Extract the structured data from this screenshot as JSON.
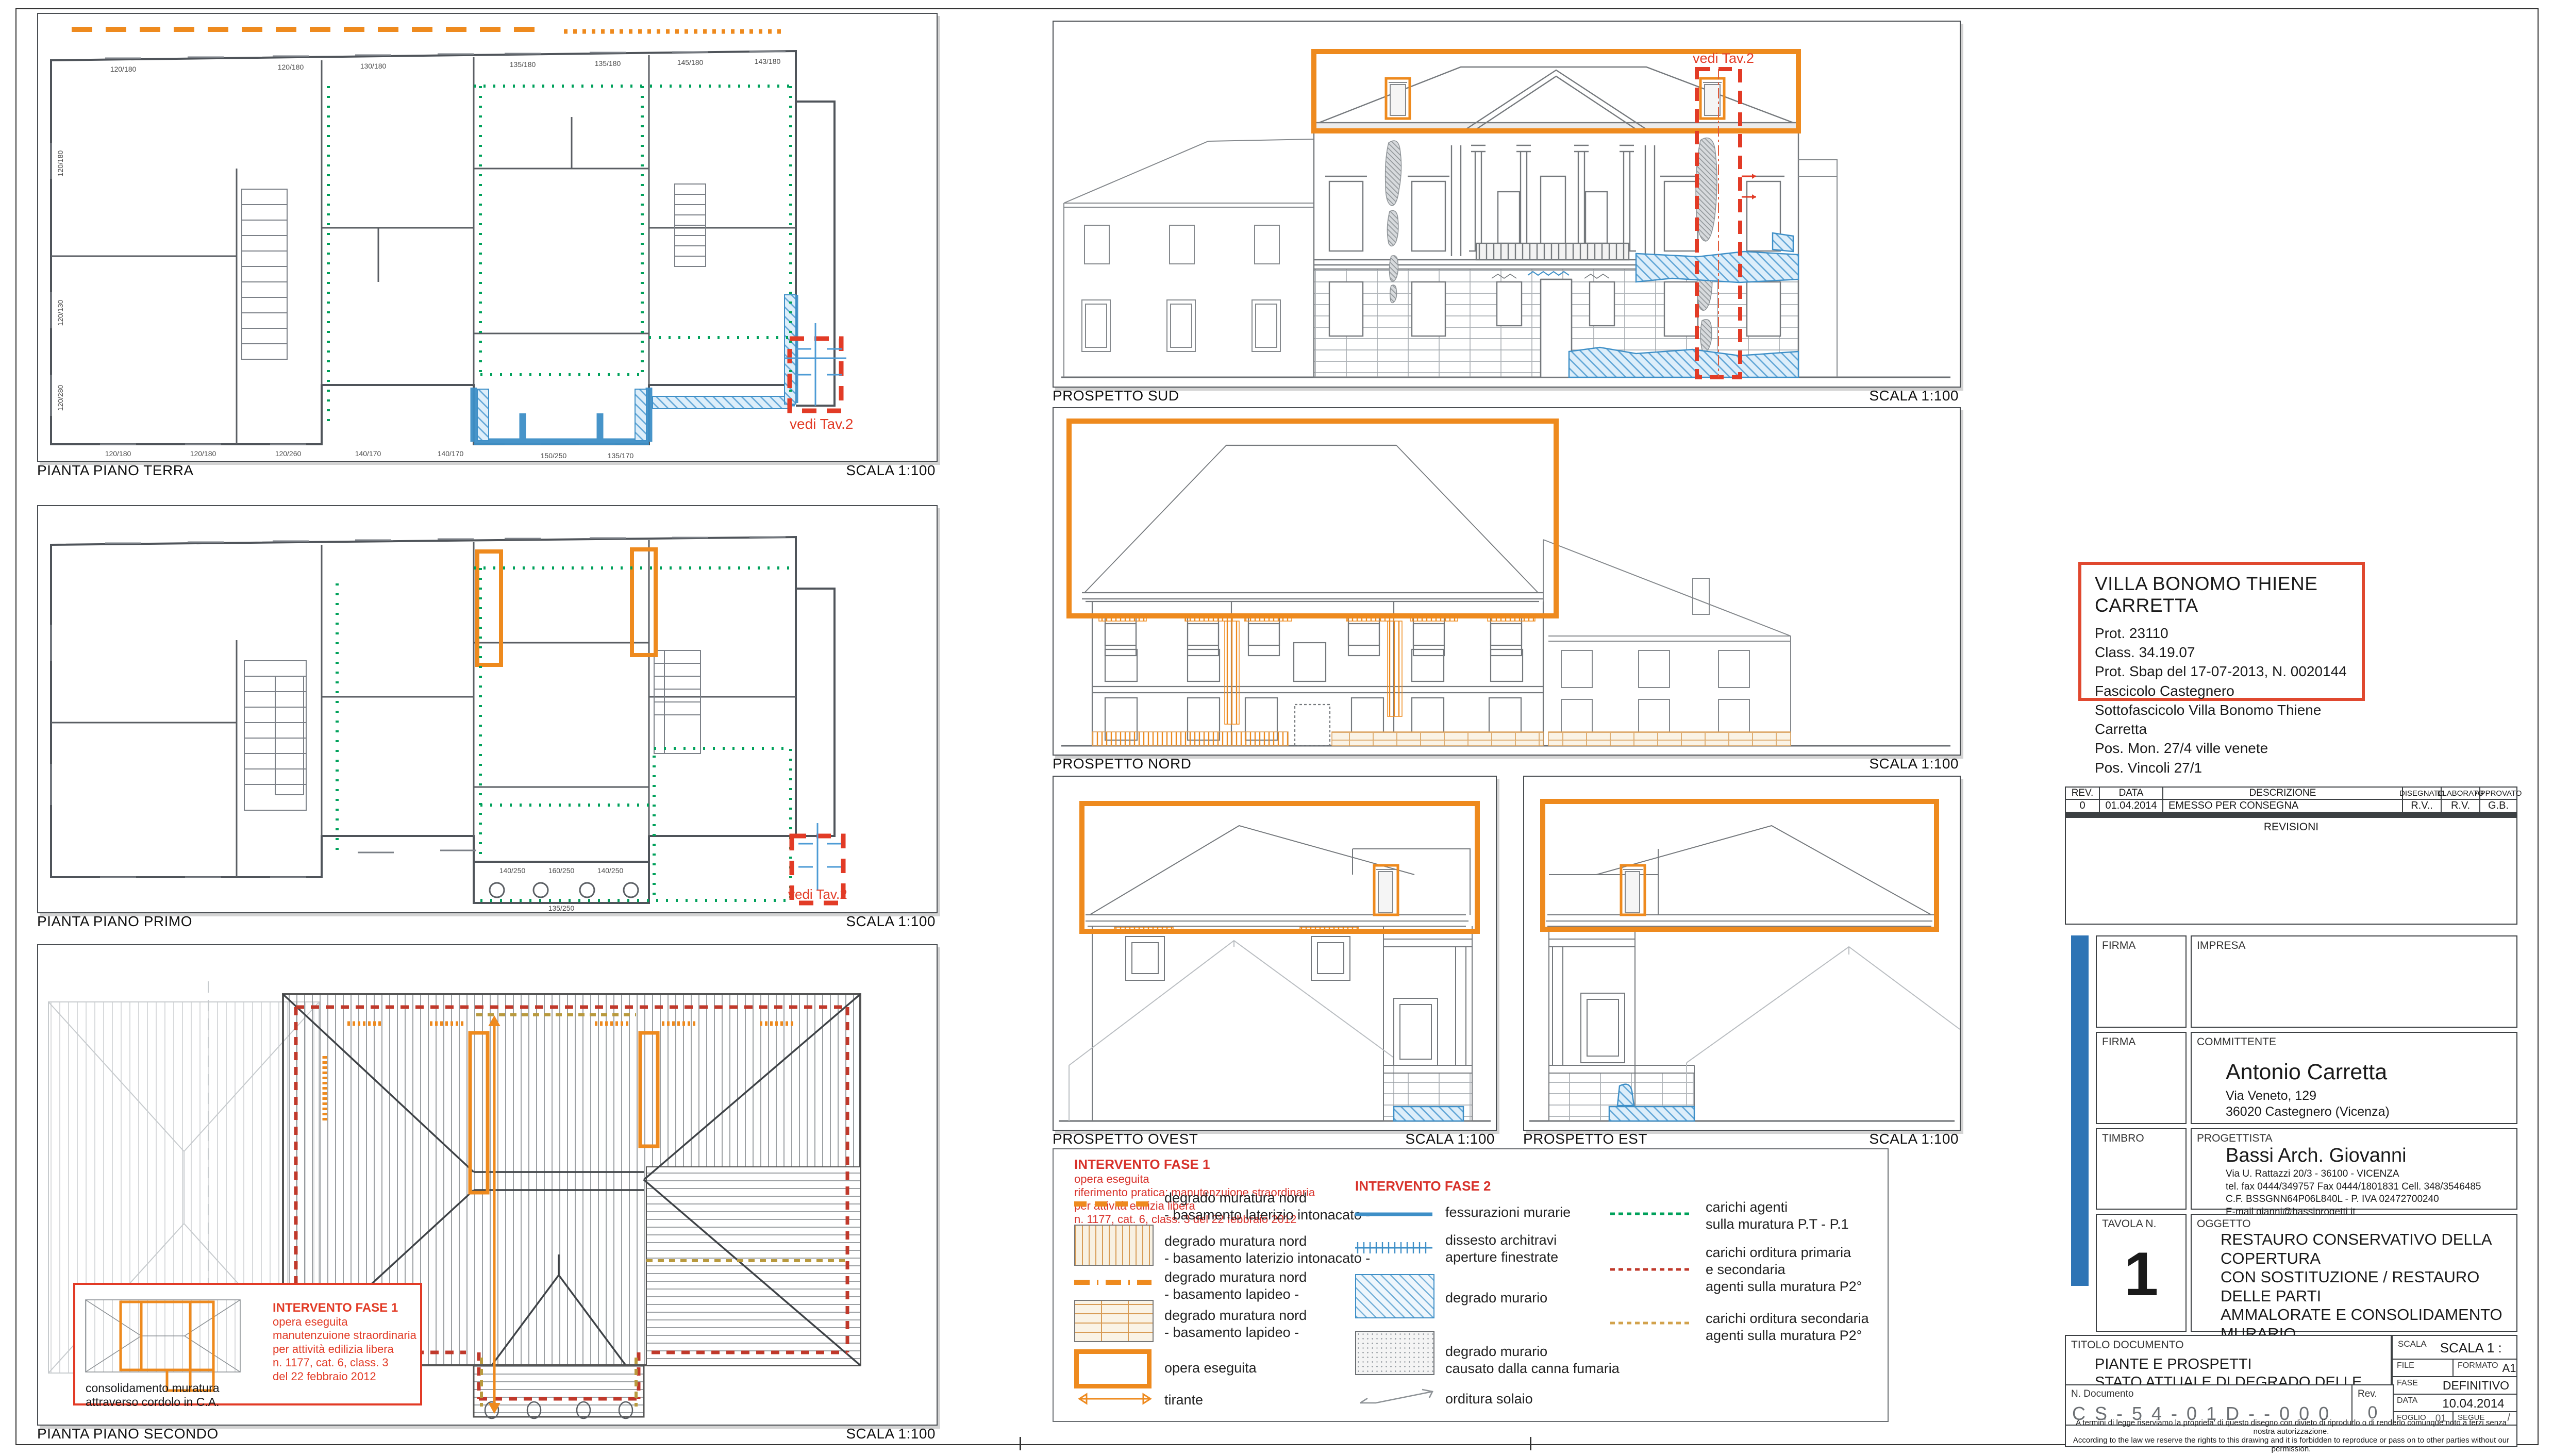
{
  "plans": [
    {
      "title": "PIANTA  PIANO TERRA",
      "scale": "SCALA 1:100"
    },
    {
      "title": "PIANTA  PIANO PRIMO",
      "scale": "SCALA 1:100"
    },
    {
      "title": "PIANTA  PIANO SECONDO",
      "scale": "SCALA 1:100"
    }
  ],
  "elevations": [
    {
      "title": "PROSPETTO SUD",
      "scale": "SCALA 1:100"
    },
    {
      "title": "PROSPETTO NORD",
      "scale": "SCALA 1:100"
    },
    {
      "title": "PROSPETTO OVEST",
      "scale": "SCALA 1:100"
    },
    {
      "title": "PROSPETTO EST",
      "scale": "SCALA 1:100"
    }
  ],
  "annotations": {
    "vedi_tav2": "vedi Tav.2",
    "consolidamento": "consolidamento muratura\nattraverso cordolo in C.A.",
    "inset_fase1": {
      "title": "INTERVENTO FASE 1",
      "lines": "opera eseguita\nmanutenzuione straordinaria\nper attività edilizia libera\nn. 1177, cat. 6, class. 3\ndel 22 febbraio 2012"
    },
    "dims": {
      "terra_top": [
        "120/180",
        "120/180",
        "130/180",
        "135/180",
        "135/180",
        "145/180",
        "143/180"
      ],
      "terra_left": [
        "120/180",
        "120/130",
        "120/280"
      ],
      "terra_bottom": [
        "120/180",
        "120/180",
        "120/260",
        "140/170",
        "140/170",
        "150/250",
        "135/170"
      ],
      "primo_bottom": [
        "140/250",
        "160/250",
        "140/250",
        "135/250"
      ]
    }
  },
  "legend": {
    "fase1": {
      "title": "INTERVENTO FASE 1",
      "sublines": "opera eseguita\nriferimento pratica: manutenzuione straordinaria\nper attività edilizia libera\nn. 1177, cat. 6, class. 3 del 22 febbraio 2012",
      "items": [
        {
          "symbol": "orange-dashed-line",
          "label": "degrado muratura nord\n- basamento laterizio intonacato -"
        },
        {
          "symbol": "hatch-vertical-box",
          "label": "degrado muratura nord\n- basamento laterizio intonacato -"
        },
        {
          "symbol": "orange-dashdot-line",
          "label": "degrado muratura nord\n- basamento lapideo -"
        },
        {
          "symbol": "hatch-brick-box",
          "label": "degrado muratura nord\n- basamento lapideo -"
        },
        {
          "symbol": "orange-outline-box",
          "label": "opera eseguita"
        },
        {
          "symbol": "double-arrow",
          "label": "tirante"
        }
      ]
    },
    "fase2": {
      "title": "INTERVENTO FASE 2",
      "items": [
        {
          "symbol": "blue-line",
          "label": "fessurazioni murarie"
        },
        {
          "symbol": "blue-tick-line",
          "label": "dissesto architravi\naperture finestrate"
        },
        {
          "symbol": "blue-hatch-box",
          "label": "degrado murario"
        },
        {
          "symbol": "gray-dot-box",
          "label": "degrado murario\ncausato dalla canna fumaria"
        },
        {
          "symbol": "solaio-arrow",
          "label": "orditura solaio"
        }
      ]
    },
    "carichi": {
      "items": [
        {
          "symbol": "green-dashed-line",
          "label": "carichi agenti\nsulla muratura P.T - P.1"
        },
        {
          "symbol": "red-dashed-line",
          "label": "carichi orditura primaria\ne secondaria\nagenti sulla muratura P2°"
        },
        {
          "symbol": "tan-dashed-line",
          "label": "carichi orditura secondaria\nagenti sulla muratura P2°"
        }
      ]
    }
  },
  "info_box": {
    "title": "VILLA BONOMO THIENE CARRETTA",
    "lines": "Prot. 23110\nClass. 34.19.07\nProt. Sbap del 17-07-2013, N. 0020144\nFascicolo Castegnero\nSottofascicolo Villa Bonomo Thiene Carretta\nPos. Mon. 27/4 ville venete\nPos. Vincoli 27/1"
  },
  "title_block": {
    "revisions": {
      "headers": [
        "REV.",
        "DATA",
        "DESCRIZIONE",
        "DISEGNATO",
        "ELABORATO",
        "APPROVATO"
      ],
      "row0": {
        "rev": "0",
        "data": "01.04.2014",
        "descrizione": "EMESSO PER CONSEGNA",
        "disegnato": "R.V..",
        "elaborato": "R.V.",
        "approvato": "G.B."
      },
      "footer": "REVISIONI"
    },
    "firma_label": "FIRMA",
    "impresa_label": "IMPRESA",
    "timbro_label": "TIMBRO",
    "committente": {
      "label": "COMMITTENTE",
      "name": "Antonio Carretta",
      "lines": "Via Veneto, 129\n36020 Castegnero (Vicenza)"
    },
    "progettista": {
      "label": "PROGETTISTA",
      "name": "Bassi Arch. Giovanni",
      "lines": "Via U. Rattazzi 20/3 -  36100 - VICENZA\ntel. fax 0444/349757 Fax 0444/1801831 Cell. 348/3546485\nC.F. BSSGNN64P06L840L -  P. IVA 02472700240\nE-mail gianni@bassiprogetti.it"
    },
    "tavola": {
      "label": "TAVOLA  N.",
      "number": "1"
    },
    "oggetto": {
      "label": "OGGETTO",
      "lines": "RESTAURO CONSERVATIVO DELLA COPERTURA\nCON SOSTITUZIONE / RESTAURO DELLE PARTI\nAMMALORATE E CONSOLIDAMENTO MURARIO",
      "red_lines": "RICHIESTA DOCUMENTAZIONE INTEGRATIVA\nDEL 16.08.2013"
    },
    "titolo": {
      "label": "TITOLO DOCUMENTO",
      "lines": "PIANTE  E PROSPETTI\nSTATO ATTUALE DI DEGRADO DELLE MURATURE"
    },
    "scala": {
      "label": "SCALA",
      "value": "SCALA 1 : 100"
    },
    "file": {
      "label": "FILE",
      "value": ""
    },
    "formato": {
      "label": "FORMATO",
      "value": "A1"
    },
    "fase": {
      "label": "FASE",
      "value": "DEFINITIVO"
    },
    "documento": {
      "label": "N. Documento",
      "value": "C S - 5 4 - 0 1 D - - 0 0 0"
    },
    "rev": {
      "label": "Rev.",
      "value": "0"
    },
    "data": {
      "label": "DATA",
      "value": "10.04.2014"
    },
    "foglio": {
      "label": "FOGLIO",
      "value": "01"
    },
    "segue": {
      "label": "SEGUE",
      "value": "/"
    },
    "disclaimer_it": "A termini di legge riserviamo la proprieta' di questo disegno con divieto di riprodurlo o di renderlo comunque noto a terzi senza nostra autorizzazione.",
    "disclaimer_en": "According to the law we reserve the rights to this drawing and it is forbidden to reproduce or pass on to other parties without our permission."
  },
  "colors": {
    "accent_orange": "#EE8A1E",
    "degrado_blue": "#4D9BD5",
    "carichi_green": "#00A15B",
    "carichi_red": "#C0392B",
    "carichi_tan": "#D2A24C",
    "annotation_red": "#E23B26",
    "titleblock_blue": "#2E74B5"
  }
}
